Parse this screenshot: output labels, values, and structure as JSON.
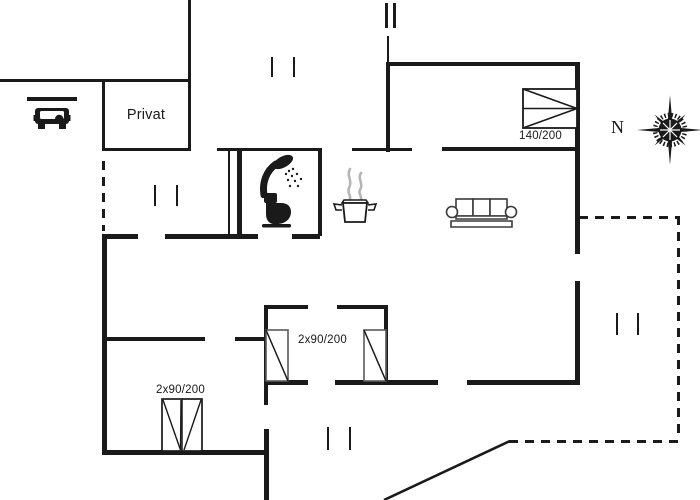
{
  "floorplan": {
    "type": "holiday-house floor plan",
    "colors": {
      "background": "#ffffff",
      "line": "#1a1a1a",
      "furniture_outline": "#5a5a5a",
      "steam": "#b5b5b5"
    },
    "labels": {
      "private_room": "Privat",
      "double_bed_dimension": "140/200",
      "twin_beds_middle_dimension": "2x90/200",
      "twin_beds_lower_dimension": "2x90/200",
      "compass_north": "N"
    },
    "icons": {
      "car": "car-icon",
      "carport_roof": "carport-roof",
      "shower": "shower-icon",
      "toilet": "toilet-icon",
      "cooking_pot": "cooking-pot-icon",
      "sofa": "sofa-icon",
      "double_bed": "double-bed-icon",
      "single_bed_left": "single-bed-icon",
      "single_bed_right": "single-bed-icon",
      "twin_bed": "twin-bed-icon",
      "compass": "compass-rose-icon"
    }
  }
}
